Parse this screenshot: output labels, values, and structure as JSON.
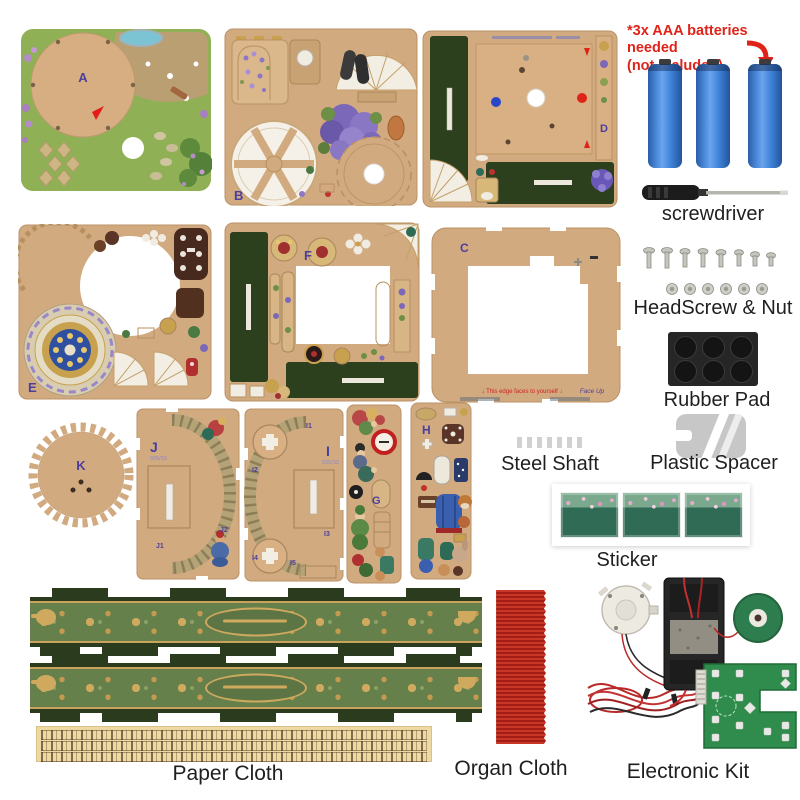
{
  "notice": {
    "line1": "*3x AAA batteries needed",
    "line2": "(not included)"
  },
  "boards": {
    "a": {
      "letter": "A"
    },
    "b": {
      "letter": "B"
    },
    "c": {
      "letter": "C",
      "edge_note": "↓ This edge faces to yourself ↓",
      "face_up": "Face Up"
    },
    "d": {
      "letter": "D"
    },
    "e": {
      "letter": "E"
    },
    "f": {
      "letter": "F"
    },
    "g": {
      "letter": "G"
    },
    "h": {
      "letter": "H"
    },
    "i": {
      "letter": "I",
      "code": "935/33",
      "subparts": [
        "I1",
        "I2",
        "I3",
        "I4",
        "I5"
      ]
    },
    "j": {
      "letter": "J",
      "code": "935/33",
      "subparts": [
        "J1",
        "J2"
      ]
    },
    "k": {
      "letter": "K"
    }
  },
  "accessories": {
    "screwdriver": {
      "label": "screwdriver"
    },
    "headscrew_nut": {
      "label": "HeadScrew & Nut"
    },
    "rubber_pad": {
      "label": "Rubber Pad"
    },
    "steel_shaft": {
      "label": "Steel Shaft"
    },
    "plastic_spacer": {
      "label": "Plastic Spacer"
    },
    "sticker": {
      "label": "Sticker"
    },
    "paper_cloth": {
      "label": "Paper Cloth"
    },
    "organ_cloth": {
      "label": "Organ Cloth"
    },
    "electronic_kit": {
      "label": "Electronic Kit"
    }
  },
  "colors": {
    "notice_red": "#e02318",
    "battery_blue": "#3b7fd4",
    "kraft_board": "#d2aa80",
    "panel_dark_green": "#2c401d",
    "board_letter_purple": "#4a3f9f",
    "organ_cloth_red": "#b52417",
    "pcb_green": "#2f8c4c",
    "sticker_green": "#2f6b55"
  }
}
